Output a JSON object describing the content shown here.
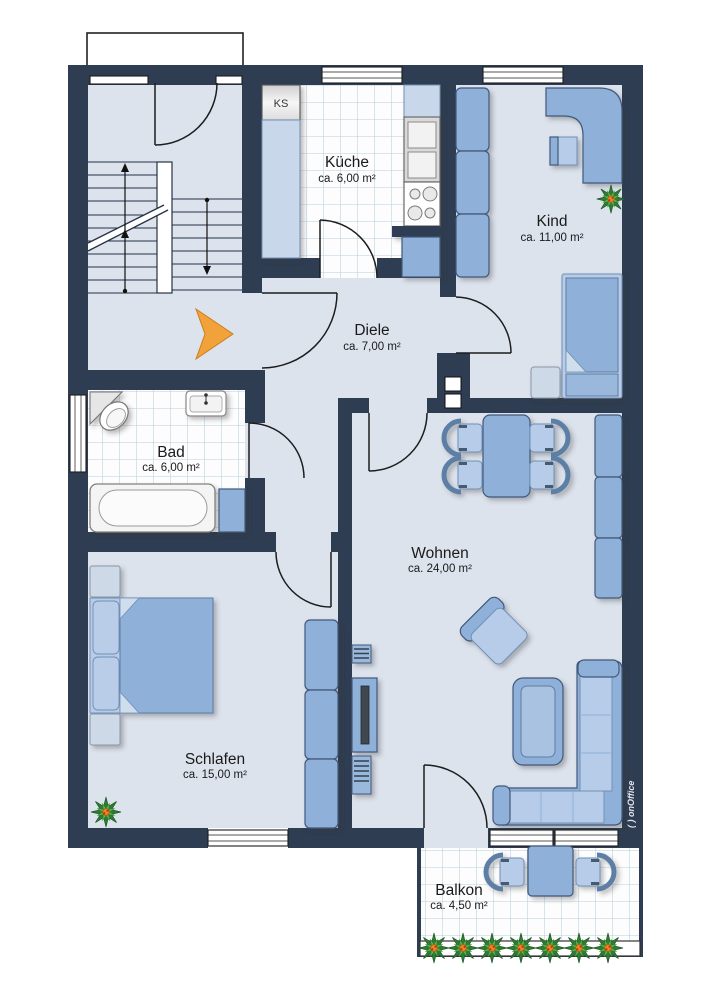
{
  "plan": {
    "rooms": [
      {
        "id": "kueche",
        "name": "Küche",
        "area": "ca. 6,00 m²"
      },
      {
        "id": "kind",
        "name": "Kind",
        "area": "ca. 11,00 m²"
      },
      {
        "id": "diele",
        "name": "Diele",
        "area": "ca. 7,00 m²"
      },
      {
        "id": "bad",
        "name": "Bad",
        "area": "ca. 6,00 m²"
      },
      {
        "id": "wohnen",
        "name": "Wohnen",
        "area": "ca. 24,00 m²"
      },
      {
        "id": "schlafen",
        "name": "Schlafen",
        "area": "ca. 15,00 m²"
      },
      {
        "id": "balkon",
        "name": "Balkon",
        "area": "ca. 4,50 m²"
      }
    ],
    "labels": {
      "fridge": "KS"
    },
    "watermark": "( ) onOffice",
    "palette": {
      "wall": "#2e3d52",
      "floor": "#dde3ed",
      "furn": "#8fb1d9",
      "furnlight": "#b6cce8",
      "furnpale": "#cdd9e7",
      "line": "#41597a",
      "tileline": "#b7cfdf",
      "accent": "#f2a23b",
      "plantgreen": "#3a8f3c"
    }
  }
}
